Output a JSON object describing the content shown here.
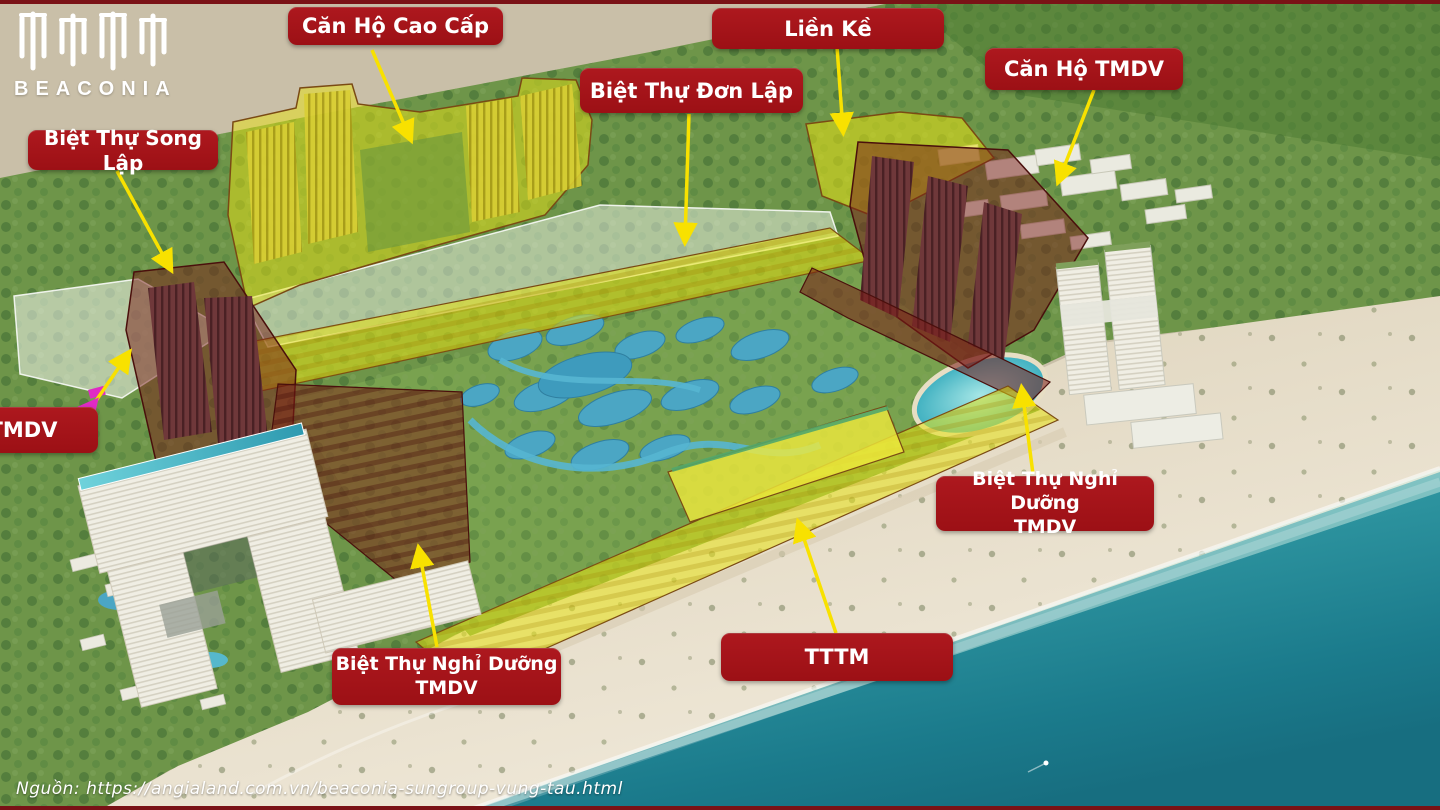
{
  "logo": {
    "brand": "BEACONIA"
  },
  "source_note": "Nguồn: https://angialand.com.vn/beaconia-sungroup-vung-tau.html",
  "labels": [
    {
      "id": "can-ho-cao-cap",
      "text": "Căn Hộ Cao Cấp"
    },
    {
      "id": "lien-ke",
      "text": "Liền Kề"
    },
    {
      "id": "biet-thu-don-lap",
      "text": "Biệt Thự Đơn Lập"
    },
    {
      "id": "can-ho-tmdv",
      "text": "Căn Hộ TMDV"
    },
    {
      "id": "biet-thu-song-lap",
      "text": "Biệt Thự Song Lập"
    },
    {
      "id": "tmdv",
      "text": "TMDV"
    },
    {
      "id": "biet-thu-nghi-duong-tmdv-right",
      "text": "Biệt Thự Nghỉ Dưỡng\nTMDV"
    },
    {
      "id": "biet-thu-nghi-duong-tmdv-beach",
      "text": "Biệt Thự Nghỉ Dưỡng\nTMDV"
    },
    {
      "id": "tttm",
      "text": "TTTM"
    }
  ],
  "colors": {
    "label_background": "#A4151B",
    "label_text": "#FFFFFF",
    "arrow_yellow": "#F8E100",
    "arrow_magenta": "#E02BC4",
    "highlight_yellow": "#E6E000",
    "highlight_maroon": "#7A1E1A",
    "highlight_white": "#FFFFFF",
    "ocean_teal": "#2E8A94",
    "slide_border_red": "#7A1216"
  }
}
